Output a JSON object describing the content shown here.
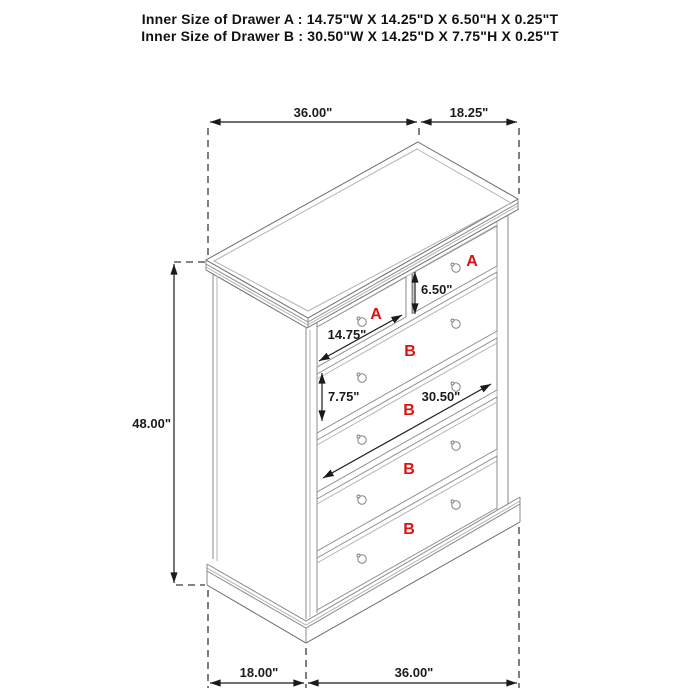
{
  "header": {
    "line1": "Inner Size of Drawer A : 14.75\"W X 14.25\"D X 6.50\"H X 0.25\"T",
    "line2": "Inner Size of Drawer B : 30.50\"W X 14.25\"D X 7.75\"H X 0.25\"T"
  },
  "dimensions": {
    "top_width": "36.00\"",
    "top_depth": "18.25\"",
    "overall_height": "48.00\"",
    "drawer_a_height": "6.50\"",
    "drawer_a_width": "14.75\"",
    "drawer_b_height": "7.75\"",
    "drawer_b_width": "30.50\"",
    "bottom_depth": "18.00\"",
    "bottom_width": "36.00\""
  },
  "drawer_labels": {
    "a_left": "A",
    "a_right": "A",
    "b1": "B",
    "b2": "B",
    "b3": "B",
    "b4": "B"
  },
  "colors": {
    "background": "#ffffff",
    "accent_red": "#dd1111",
    "line_gray": "#8a8a8a",
    "dimension_black": "#1b1b1b"
  }
}
